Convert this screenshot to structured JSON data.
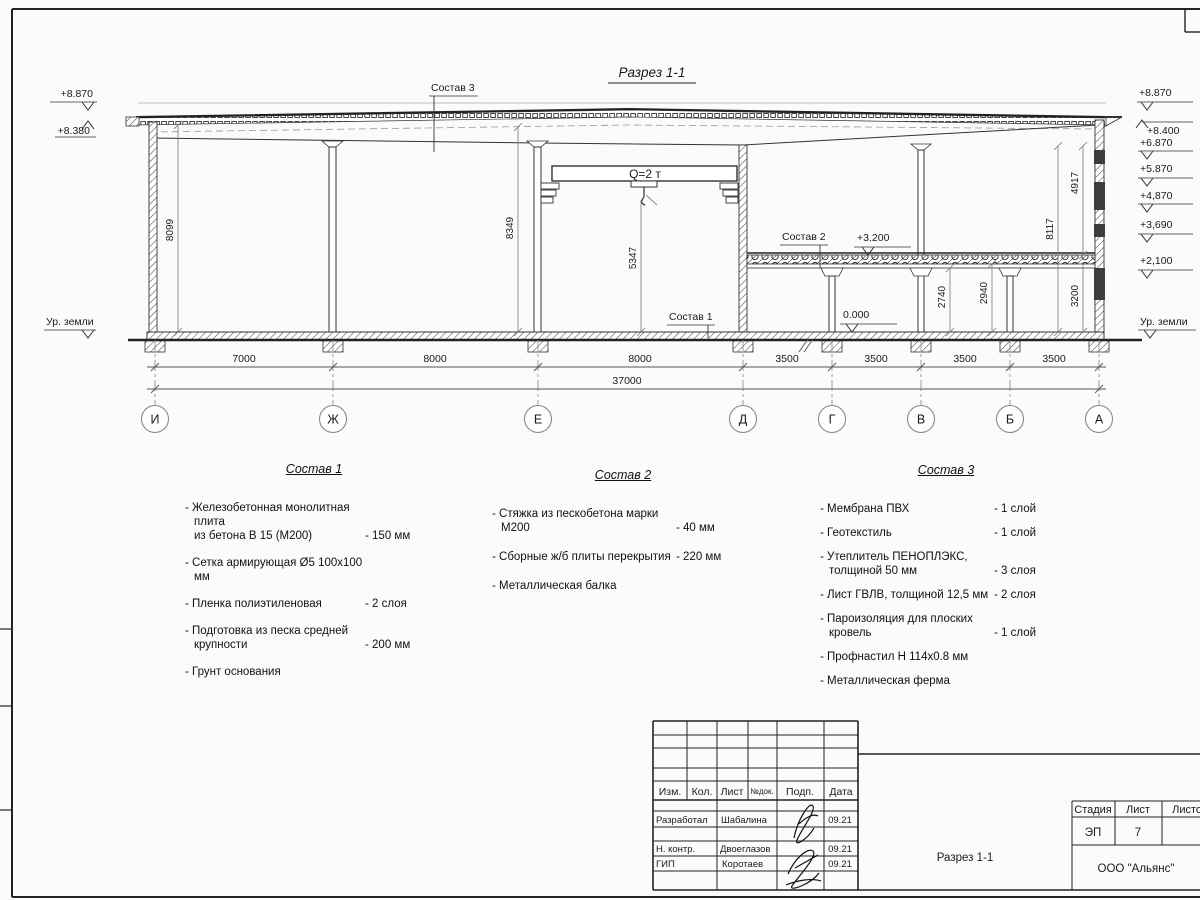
{
  "drawing": {
    "title": "Разрез 1-1",
    "crane_label": "Q=2 т",
    "ground_left": "Ур. земли",
    "ground_right": "Ур. земли",
    "elev_left": [
      "+8.870",
      "+8.380"
    ],
    "elev_right": [
      "+8.870",
      "+8.400",
      "+6.870",
      "+5.870",
      "+4,870",
      "+3,690",
      "+2,100"
    ],
    "zero_mark": "0.000",
    "slab_mark": "+3.200",
    "leaders": {
      "s1": "Состав 1",
      "s2": "Состав 2",
      "s3": "Состав 3"
    },
    "vdims": {
      "wall_left": "8099",
      "mid": "8349",
      "crane": "5347",
      "under_beam": "2740",
      "under_slab": "2940",
      "floor1": "3200",
      "right_full": "8117",
      "right_upper": "4917"
    },
    "spans": [
      "7000",
      "8000",
      "8000",
      "3500",
      "3500",
      "3500",
      "3500"
    ],
    "total": "37000",
    "axes": [
      "И",
      "Ж",
      "Е",
      "Д",
      "Г",
      "В",
      "Б",
      "А"
    ]
  },
  "compositions": [
    {
      "title": "Состав 1",
      "items": [
        {
          "name": "- Железобетонная  монолитная плита\nиз бетона В 15 (М200)",
          "value": "- 150 мм"
        },
        {
          "name": "- Сетка армирующая Ø5 100x100 мм",
          "value": ""
        },
        {
          "name": "- Пленка полиэтиленовая",
          "value": "-  2 слоя"
        },
        {
          "name": "- Подготовка из песка средней\nкрупности",
          "value": "- 200 мм"
        },
        {
          "name": "- Грунт основания",
          "value": ""
        }
      ]
    },
    {
      "title": "Состав 2",
      "items": [
        {
          "name": "- Стяжка из пескобетона марки М200",
          "value": "- 40 мм"
        },
        {
          "name": "- Сборные ж/б плиты перекрытия",
          "value": "- 220 мм"
        },
        {
          "name": "- Металлическая балка",
          "value": ""
        }
      ]
    },
    {
      "title": "Состав 3",
      "items": [
        {
          "name": "- Мембрана ПВХ",
          "value": "- 1 слой"
        },
        {
          "name": "- Геотекстиль",
          "value": "- 1 слой"
        },
        {
          "name": "- Утеплитель ПЕНОПЛЭКС,\nтолщиной 50 мм",
          "value": "- 3 слоя"
        },
        {
          "name": "- Лист ГВЛВ, толщиной 12,5 мм",
          "value": "- 2 слоя"
        },
        {
          "name": "- Пароизоляция для плоских кровель",
          "value": "- 1 слой"
        },
        {
          "name": "- Профнастил Н 114x0.8 мм",
          "value": ""
        },
        {
          "name": "- Металлическая ферма",
          "value": ""
        }
      ]
    }
  ],
  "titleblock": {
    "cols": [
      "Изм.",
      "Кол.",
      "Лист",
      "№док.",
      "Подп.",
      "Дата"
    ],
    "rows": [
      {
        "role": "Разработал",
        "name": "Шабалина",
        "date": "09.21"
      },
      {
        "role": "Н. контр.",
        "name": "Двоеглазов",
        "date": "09.21"
      },
      {
        "role": "ГИП",
        "name": "Коротаев",
        "date": "09.21"
      }
    ],
    "doc_title": "Разрез 1-1",
    "stage_label": "Стадия",
    "sheet_label": "Лист",
    "sheets_label": "Листов",
    "stage": "ЭП",
    "sheet": "7",
    "company": "ООО \"Альянс\""
  }
}
